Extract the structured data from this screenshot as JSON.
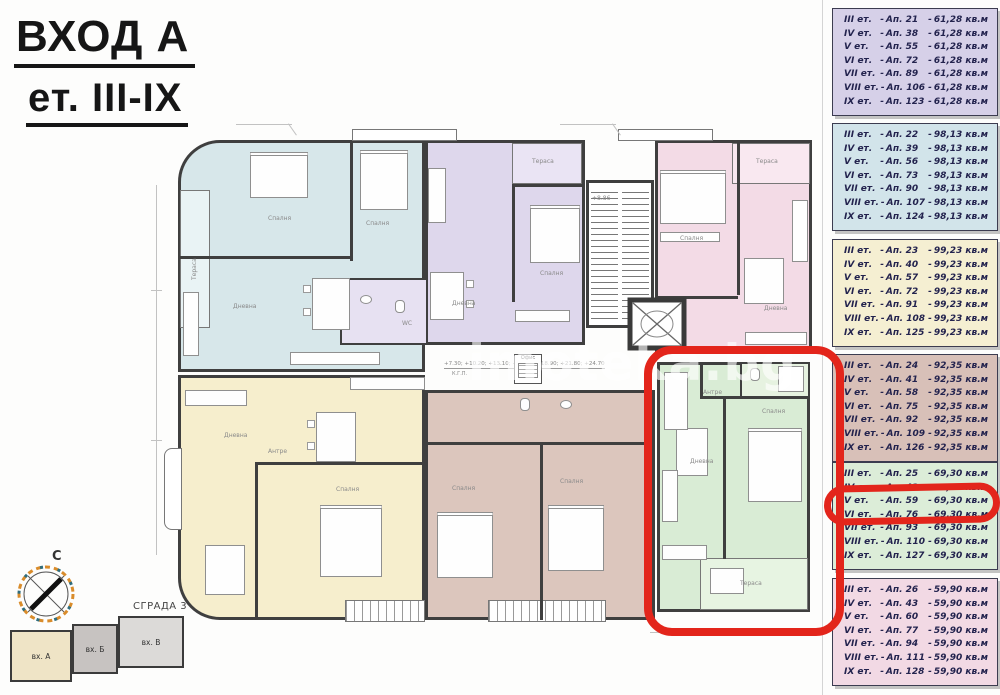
{
  "title": {
    "line1": "ВХОД А",
    "line2": "ет. III-IX"
  },
  "watermark": "imoteka.bg",
  "compass": {
    "north_label": "С"
  },
  "site_plan": {
    "title": "СГРАДА 3",
    "blocks": [
      {
        "label": "вх. А"
      },
      {
        "label": "вх. Б"
      },
      {
        "label": "вх. В"
      }
    ]
  },
  "plan": {
    "levels_note": "+7.30; +10.20; +13.10; +16.00; +18.90; +21.80; +24.70",
    "kgp_label": "К.Г.П.",
    "stairs_level": "+8.86",
    "labels": {
      "terrace": "Тераса",
      "bedroom": "Спалня",
      "living": "Дневна",
      "hall": "Антре",
      "wc": "WC",
      "office": "Офис"
    },
    "colors": {
      "cyan": "#d7e7ea",
      "purple": "#ded7ec",
      "pink": "#f3dbe6",
      "yellow": "#f6eecd",
      "tan": "#dcc6bd",
      "green": "#d9ecd5",
      "highlight_red": "#e3251b"
    }
  },
  "legend": [
    {
      "name": "apartments-61-28",
      "color": "#d6d0e8",
      "rows": [
        {
          "floor": "III ет.",
          "apt": "Ап. 21",
          "area": "61,28 кв.м"
        },
        {
          "floor": "IV ет.",
          "apt": "Ап. 38",
          "area": "61,28 кв.м"
        },
        {
          "floor": "V ет.",
          "apt": "Ап. 55",
          "area": "61,28 кв.м"
        },
        {
          "floor": "VI ет.",
          "apt": "Ап. 72",
          "area": "61,28 кв.м"
        },
        {
          "floor": "VII ет.",
          "apt": "Ап. 89",
          "area": "61,28 кв.м"
        },
        {
          "floor": "VIII ет.",
          "apt": "Ап. 106",
          "area": "61,28 кв.м"
        },
        {
          "floor": "IX ет.",
          "apt": "Ап. 123",
          "area": "61,28 кв.м"
        }
      ]
    },
    {
      "name": "apartments-98-13",
      "color": "#d2e4ea",
      "rows": [
        {
          "floor": "III ет.",
          "apt": "Ап. 22",
          "area": "98,13 кв.м"
        },
        {
          "floor": "IV ет.",
          "apt": "Ап. 39",
          "area": "98,13 кв.м"
        },
        {
          "floor": "V ет.",
          "apt": "Ап. 56",
          "area": "98,13 кв.м"
        },
        {
          "floor": "VI ет.",
          "apt": "Ап. 73",
          "area": "98,13 кв.м"
        },
        {
          "floor": "VII ет.",
          "apt": "Ап. 90",
          "area": "98,13 кв.м"
        },
        {
          "floor": "VIII ет.",
          "apt": "Ап. 107",
          "area": "98,13 кв.м"
        },
        {
          "floor": "IX ет.",
          "apt": "Ап. 124",
          "area": "98,13 кв.м"
        }
      ]
    },
    {
      "name": "apartments-99-23",
      "color": "#f5efd2",
      "rows": [
        {
          "floor": "III ет.",
          "apt": "Ап. 23",
          "area": "99,23 кв.м"
        },
        {
          "floor": "IV ет.",
          "apt": "Ап. 40",
          "area": "99,23 кв.м"
        },
        {
          "floor": "V ет.",
          "apt": "Ап. 57",
          "area": "99,23 кв.м"
        },
        {
          "floor": "VI ет.",
          "apt": "Ап. 72",
          "area": "99,23 кв.м"
        },
        {
          "floor": "VII ет.",
          "apt": "Ап. 91",
          "area": "99,23 кв.м"
        },
        {
          "floor": "VIII ет.",
          "apt": "Ап. 108",
          "area": "99,23 кв.м"
        },
        {
          "floor": "IX ет.",
          "apt": "Ап. 125",
          "area": "99,23 кв.м"
        }
      ]
    },
    {
      "name": "apartments-92-35",
      "color": "#d8c0b8",
      "rows": [
        {
          "floor": "III ет.",
          "apt": "Ап. 24",
          "area": "92,35 кв.м"
        },
        {
          "floor": "IV ет.",
          "apt": "Ап. 41",
          "area": "92,35 кв.м"
        },
        {
          "floor": "V ет.",
          "apt": "Ап. 58",
          "area": "92,35 кв.м"
        },
        {
          "floor": "VI ет.",
          "apt": "Ап. 75",
          "area": "92,35 кв.м"
        },
        {
          "floor": "VII ет.",
          "apt": "Ап. 92",
          "area": "92,35 кв.м"
        },
        {
          "floor": "VIII ет.",
          "apt": "Ап. 109",
          "area": "92,35 кв.м"
        },
        {
          "floor": "IX ет.",
          "apt": "Ап. 126",
          "area": "92,35 кв.м"
        }
      ]
    },
    {
      "name": "apartments-69-30",
      "color": "#dcedd8",
      "rows": [
        {
          "floor": "III ет.",
          "apt": "Ап. 25",
          "area": "69,30 кв.м"
        },
        {
          "floor": "IV ет.",
          "apt": "Ап. 42",
          "area": "69,30 кв.м"
        },
        {
          "floor": "V ет.",
          "apt": "Ап. 59",
          "area": "69,30 кв.м"
        },
        {
          "floor": "VI ет.",
          "apt": "Ап. 76",
          "area": "69,30 кв.м"
        },
        {
          "floor": "VII ет.",
          "apt": "Ап. 93",
          "area": "69,30 кв.м"
        },
        {
          "floor": "VIII ет.",
          "apt": "Ап. 110",
          "area": "69,30 кв.м"
        },
        {
          "floor": "IX ет.",
          "apt": "Ап. 127",
          "area": "69,30 кв.м"
        }
      ]
    },
    {
      "name": "apartments-59-90",
      "color": "#f2d9e4",
      "rows": [
        {
          "floor": "III ет.",
          "apt": "Ап. 26",
          "area": "59,90 кв.м"
        },
        {
          "floor": "IV ет.",
          "apt": "Ап. 43",
          "area": "59,90 кв.м"
        },
        {
          "floor": "V ет.",
          "apt": "Ап. 60",
          "area": "59,90 кв.м"
        },
        {
          "floor": "VI ет.",
          "apt": "Ап. 77",
          "area": "59,90 кв.м"
        },
        {
          "floor": "VII ет.",
          "apt": "Ап. 94",
          "area": "59,90 кв.м"
        },
        {
          "floor": "VIII ет.",
          "apt": "Ап. 111",
          "area": "59,90 кв.м"
        },
        {
          "floor": "IX ет.",
          "apt": "Ап. 128",
          "area": "59,90 кв.м"
        }
      ]
    }
  ],
  "highlight": {
    "legend_box_index": 4,
    "row_index": 2,
    "floor": "V ет.",
    "apt": "Ап. 59",
    "area": "69,30 кв.м"
  }
}
